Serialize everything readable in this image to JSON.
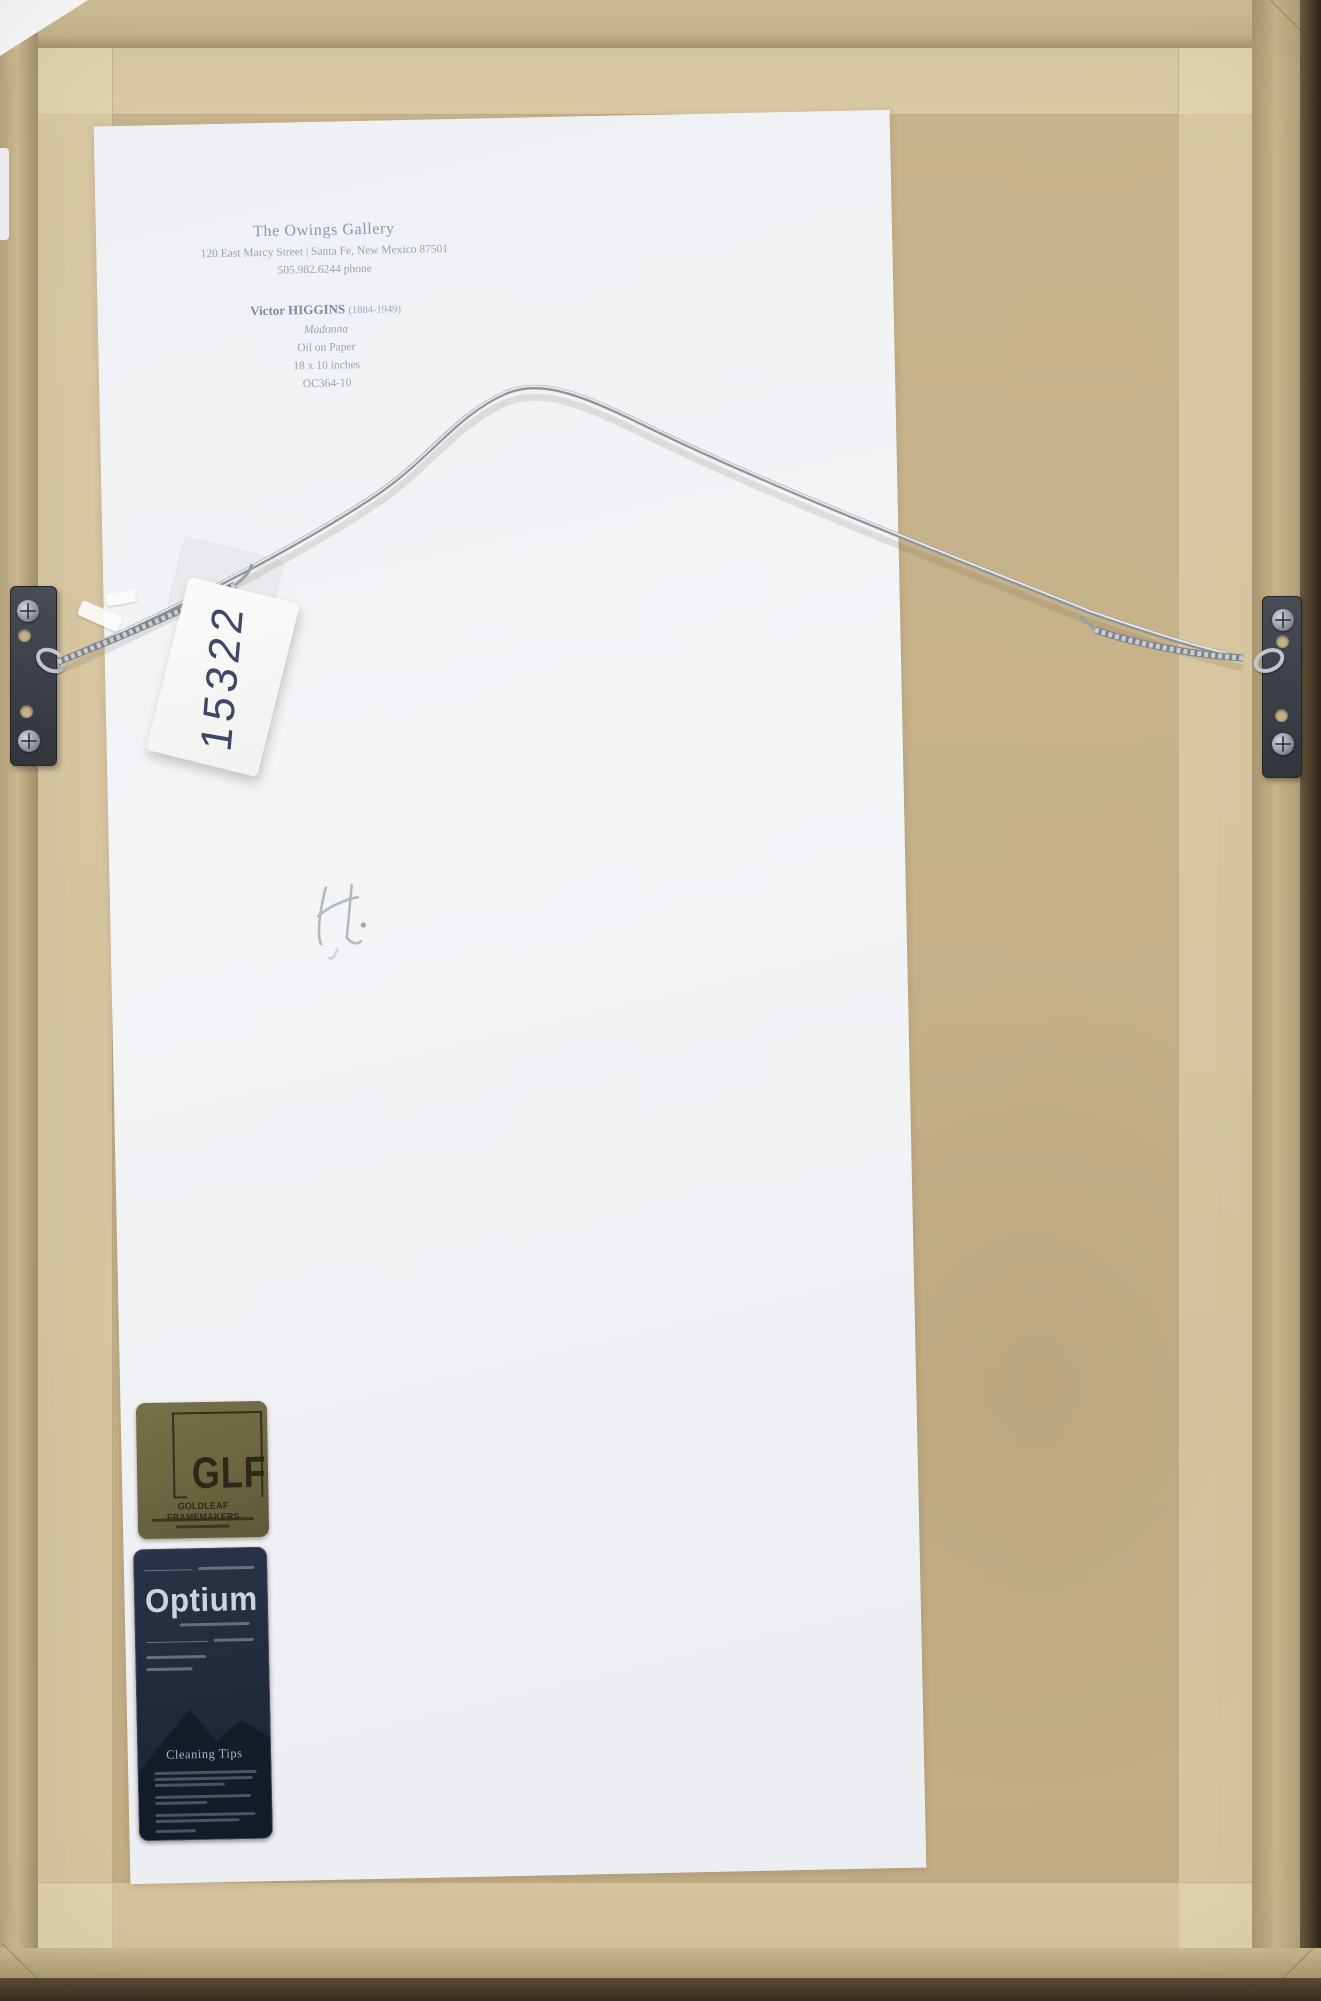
{
  "gallery_label": {
    "gallery_name": "The Owings Gallery",
    "address_line": "120 East Marcy Street  |  Santa Fe, New Mexico 87501",
    "phone_line": "505.982.6244 phone",
    "artist_name": "Victor HIGGINS",
    "artist_dates": "(1884-1949)",
    "artwork_title": "Madonna",
    "medium": "Oil on Paper",
    "dimensions": "18 x 10 inches",
    "inventory_code": "OC364-10"
  },
  "hanging_tag": {
    "number": "15322"
  },
  "framer_sticker": {
    "monogram": "GLF",
    "company": "GOLDLEAF FRAMEMAKERS"
  },
  "glazing_sticker": {
    "brand": "Optium",
    "tips_heading": "Cleaning Tips"
  },
  "colors": {
    "kraft_paper": "#c7b38b",
    "tape": "#d8c7a0",
    "frame_wood": "#cbb88f",
    "frame_dark_edge": "#4a3c2b",
    "label_paper": "#f1f2f5",
    "label_text": "#8f99af",
    "glf_sticker": "#6b6641",
    "optium_sticker": "#242b3e",
    "tag_ink": "#3e4764",
    "wire": "#9aa0a8"
  }
}
